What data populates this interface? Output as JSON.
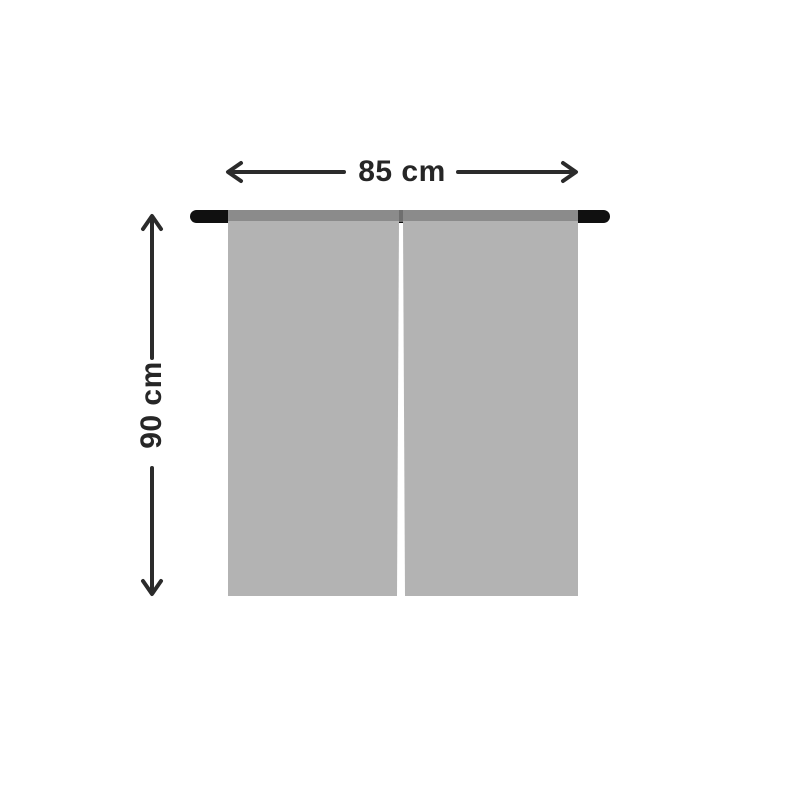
{
  "diagram": {
    "width_label": "85 cm",
    "height_label": "90 cm"
  },
  "colors": {
    "background": "#ffffff",
    "dimension": "#2b2b2b",
    "rod": "#101010",
    "rod_pocket_band": "#8b8b8b",
    "band_center_notch": "#6f6f6f",
    "panel": "#b3b3b3",
    "panel_gap": "#ffffff",
    "label": "#262626"
  }
}
